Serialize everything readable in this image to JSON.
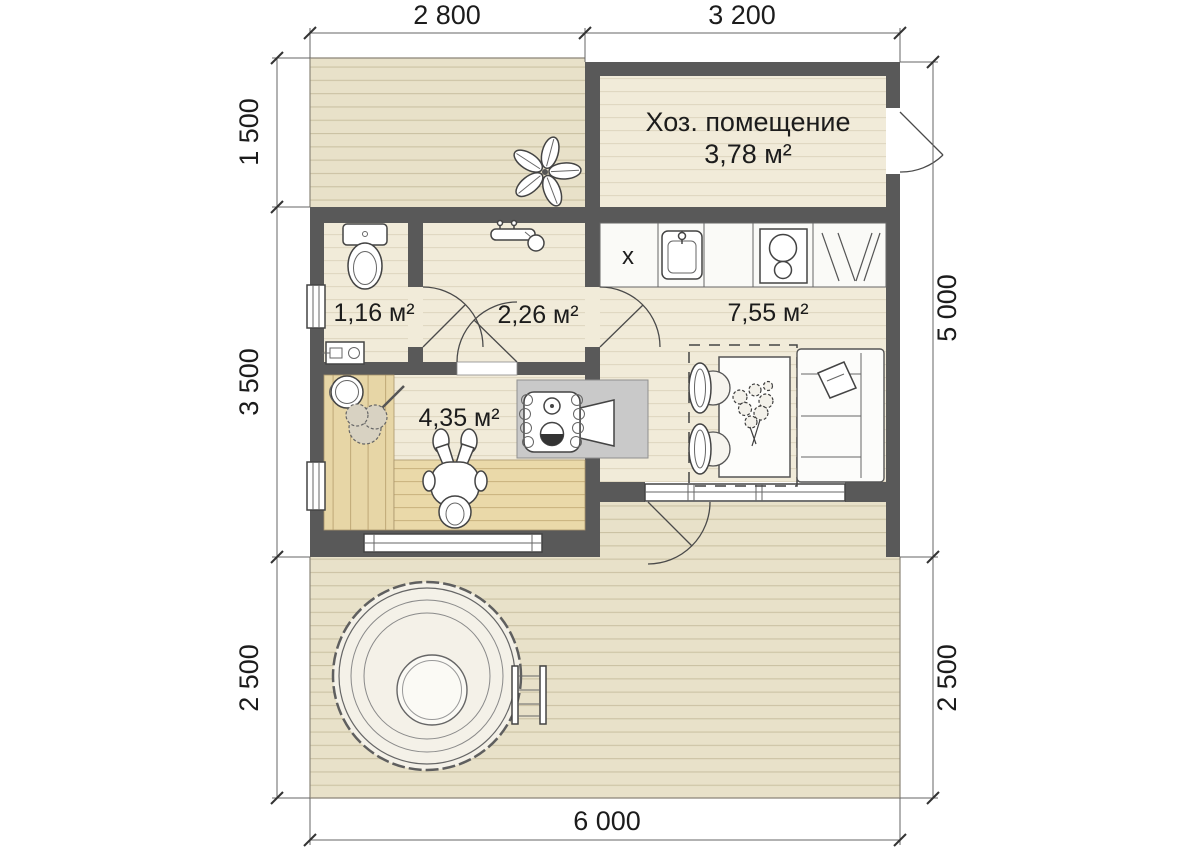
{
  "dims": {
    "top_left": "2 800",
    "top_right": "3 200",
    "left_top": "1 500",
    "left_mid": "3 500",
    "left_bottom": "2 500",
    "right_top": "5 000",
    "right_bottom": "2 500",
    "bottom": "6 000"
  },
  "rooms": {
    "utility_name": "Хоз. помещение",
    "utility_area": "3,78 м²",
    "wc_area": "1,16 м²",
    "washroom_area": "2,26 м²",
    "kitchen_living_area": "7,55 м²",
    "sauna_area": "4,35 м²"
  },
  "kitchen": {
    "counter_marker": "х"
  },
  "colors": {
    "wall": "#595959",
    "deck": "#e8e1c9",
    "floor": "#f1ebd9",
    "sauna_wood": "#e9d8a9",
    "stove_pad": "#c9c9c9"
  },
  "symbols": [
    "toilet",
    "water-heater",
    "shower-mixer",
    "kitchen-sink",
    "hob",
    "dish-drainer",
    "kitchen-counter",
    "dining-table",
    "dining-chair",
    "flower-bouquet",
    "sofa",
    "pillow",
    "sauna-stove",
    "sauna-bench",
    "bucket",
    "bath-whisk",
    "person-on-bench",
    "hot-tub",
    "hot-tub-ladder",
    "deck-plant",
    "door-swing",
    "window"
  ]
}
